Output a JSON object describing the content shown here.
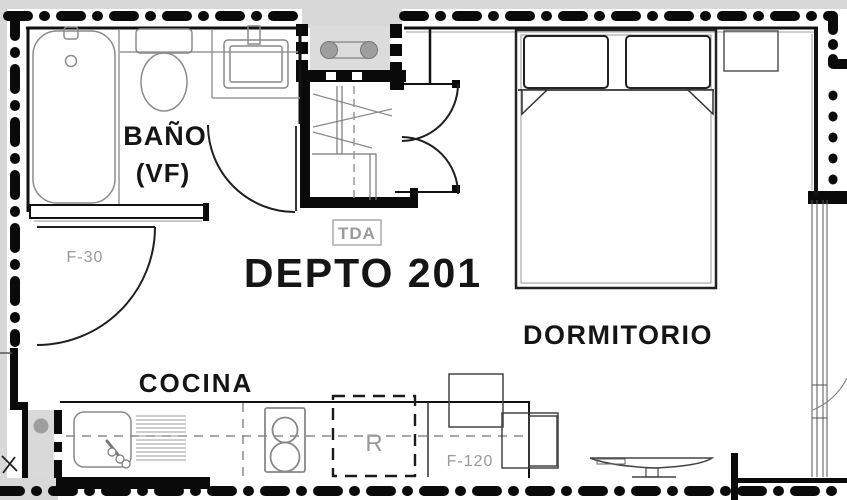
{
  "plan": {
    "unit": "DEPTO 201",
    "rooms": {
      "bathroom": {
        "name": "BAÑO",
        "subtitle": "(VF)"
      },
      "bedroom": {
        "name": "DORMITORIO"
      },
      "kitchen": {
        "name": "COCINA"
      }
    },
    "tags": {
      "closet": "TDA",
      "entry_door": "F-30",
      "window": "F-120",
      "refrigerator": "R"
    },
    "colors": {
      "wall_black": "#0a0a0a",
      "exterior_gray": "#d8d8d8",
      "fixture_gray": "#8a8a8a",
      "tag_gray": "#9a9a9a",
      "label_black": "#151515"
    }
  }
}
